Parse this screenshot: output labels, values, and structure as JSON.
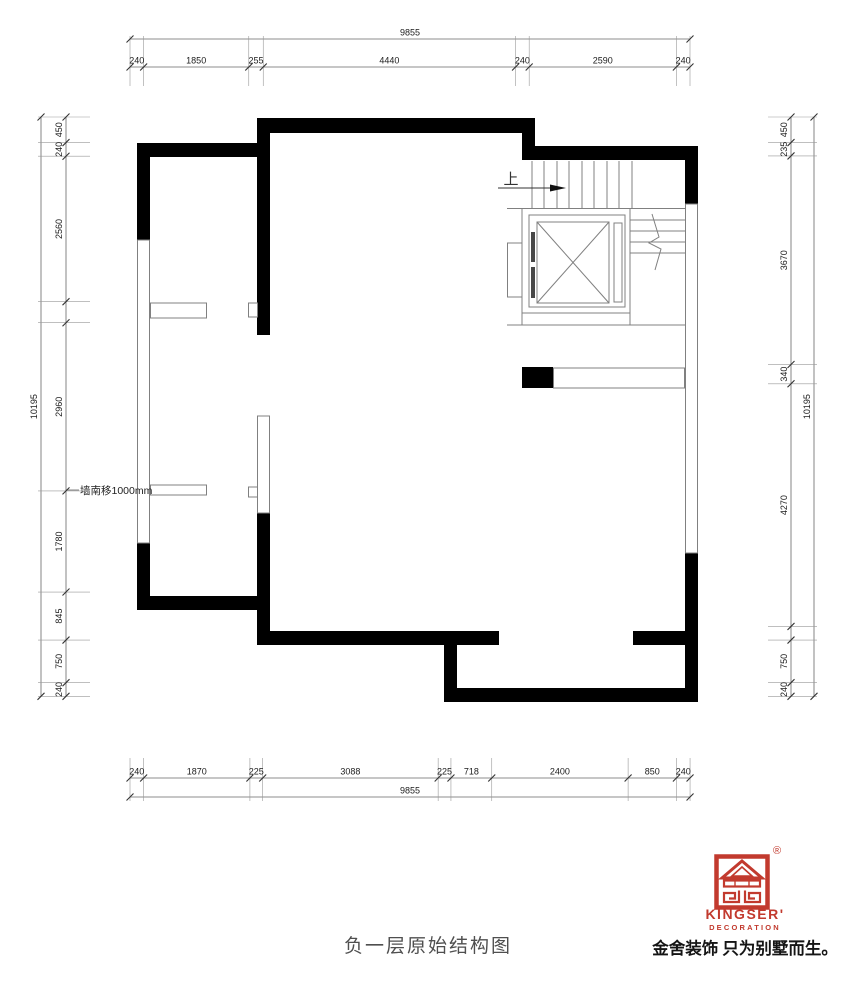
{
  "title": "负一层原始结构图",
  "annotation": "墙南移1000mm",
  "stairs": {
    "up_label": "上"
  },
  "colors": {
    "wall": "#000000",
    "thin_line": "#808080",
    "dim_line": "#666666",
    "brand_red": "#c23a2e"
  },
  "dimensions": {
    "top": {
      "overall": "9855",
      "segments": [
        {
          "label": "240",
          "mm": 240
        },
        {
          "label": "1850",
          "mm": 1850
        },
        {
          "label": "255",
          "mm": 255
        },
        {
          "label": "4440",
          "mm": 4440
        },
        {
          "label": "240",
          "mm": 240
        },
        {
          "label": "2590",
          "mm": 2590
        },
        {
          "label": "240",
          "mm": 240
        }
      ]
    },
    "bottom": {
      "overall": "9855",
      "segments": [
        {
          "label": "240",
          "mm": 240
        },
        {
          "label": "1870",
          "mm": 1870
        },
        {
          "label": "225",
          "mm": 225
        },
        {
          "label": "3088",
          "mm": 3088
        },
        {
          "label": "225",
          "mm": 225
        },
        {
          "label": "718",
          "mm": 718
        },
        {
          "label": "2400",
          "mm": 2400
        },
        {
          "label": "850",
          "mm": 850
        },
        {
          "label": "240",
          "mm": 240
        }
      ]
    },
    "left": {
      "overall": "10195",
      "segments": [
        {
          "label": "450",
          "mm": 450
        },
        {
          "label": "240",
          "mm": 240
        },
        {
          "label": "2560",
          "mm": 2560
        },
        {
          "label": "",
          "mm": 370
        },
        {
          "label": "2960",
          "mm": 2960
        },
        {
          "label": "1780",
          "mm": 1780
        },
        {
          "label": "845",
          "mm": 845
        },
        {
          "label": "750",
          "mm": 750
        },
        {
          "label": "240",
          "mm": 240
        }
      ]
    },
    "right": {
      "overall": "10195",
      "segments": [
        {
          "label": "450",
          "mm": 450
        },
        {
          "label": "235",
          "mm": 235
        },
        {
          "label": "3670",
          "mm": 3670
        },
        {
          "label": "340",
          "mm": 340
        },
        {
          "label": "4270",
          "mm": 4270
        },
        {
          "label": "",
          "mm": 240
        },
        {
          "label": "750",
          "mm": 750
        },
        {
          "label": "240",
          "mm": 240
        }
      ]
    }
  },
  "logo": {
    "registered": "®",
    "brand": "KINGSER'",
    "sub_brand": "DECORATION",
    "tagline": "金舍装饰 只为别墅而生。"
  }
}
